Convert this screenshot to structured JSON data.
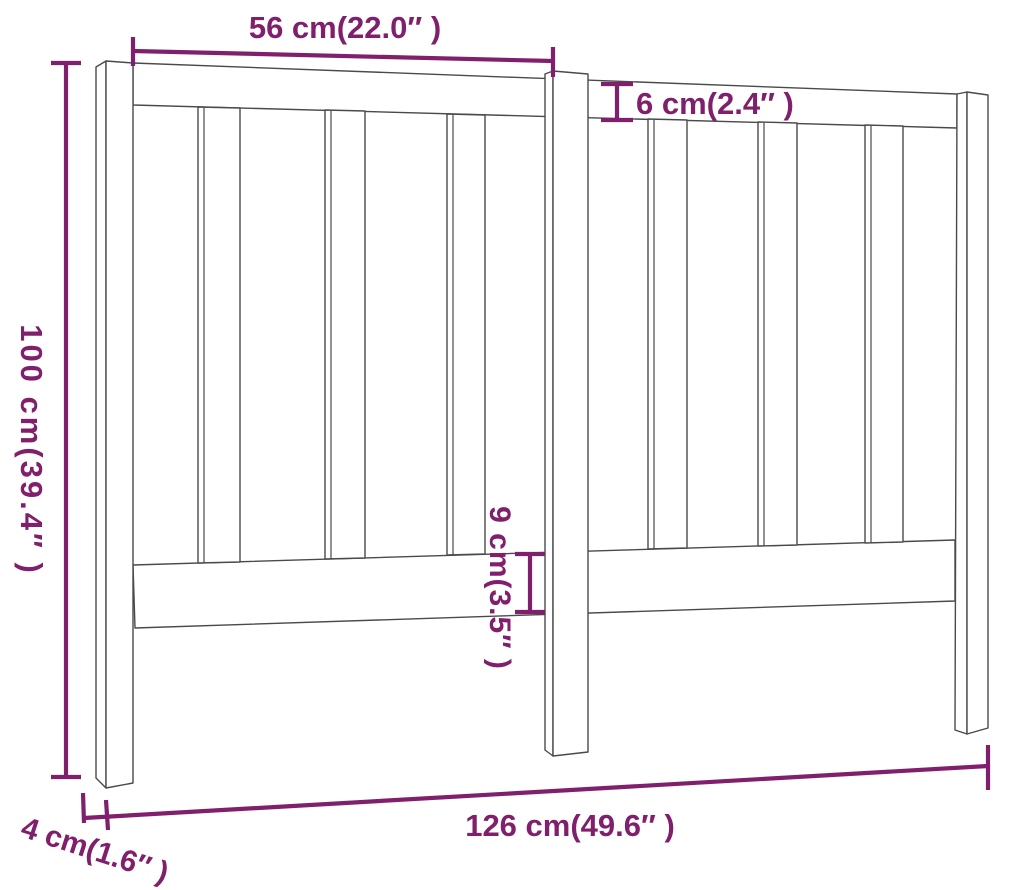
{
  "diagram": {
    "subject": "bed-headboard-dimension-drawing",
    "style": {
      "dimension_color": "#801f6c",
      "outline_color": "#4a4a4a",
      "background_color": "#ffffff"
    },
    "dimensions": {
      "top_section_width": {
        "label": "56 cm(22.0″ )",
        "cm": 56,
        "inches": 22.0
      },
      "top_rail_height": {
        "label": "6 cm(2.4″ )",
        "cm": 6,
        "inches": 2.4
      },
      "overall_height": {
        "label": "100 cm(39.4″ )",
        "cm": 100,
        "inches": 39.4
      },
      "bottom_rail_height": {
        "label": "9 cm(3.5″ )",
        "cm": 9,
        "inches": 3.5
      },
      "overall_width": {
        "label": "126 cm(49.6″ )",
        "cm": 126,
        "inches": 49.6
      },
      "leg_depth": {
        "label": "4 cm(1.6″ )",
        "cm": 4,
        "inches": 1.6
      }
    }
  }
}
